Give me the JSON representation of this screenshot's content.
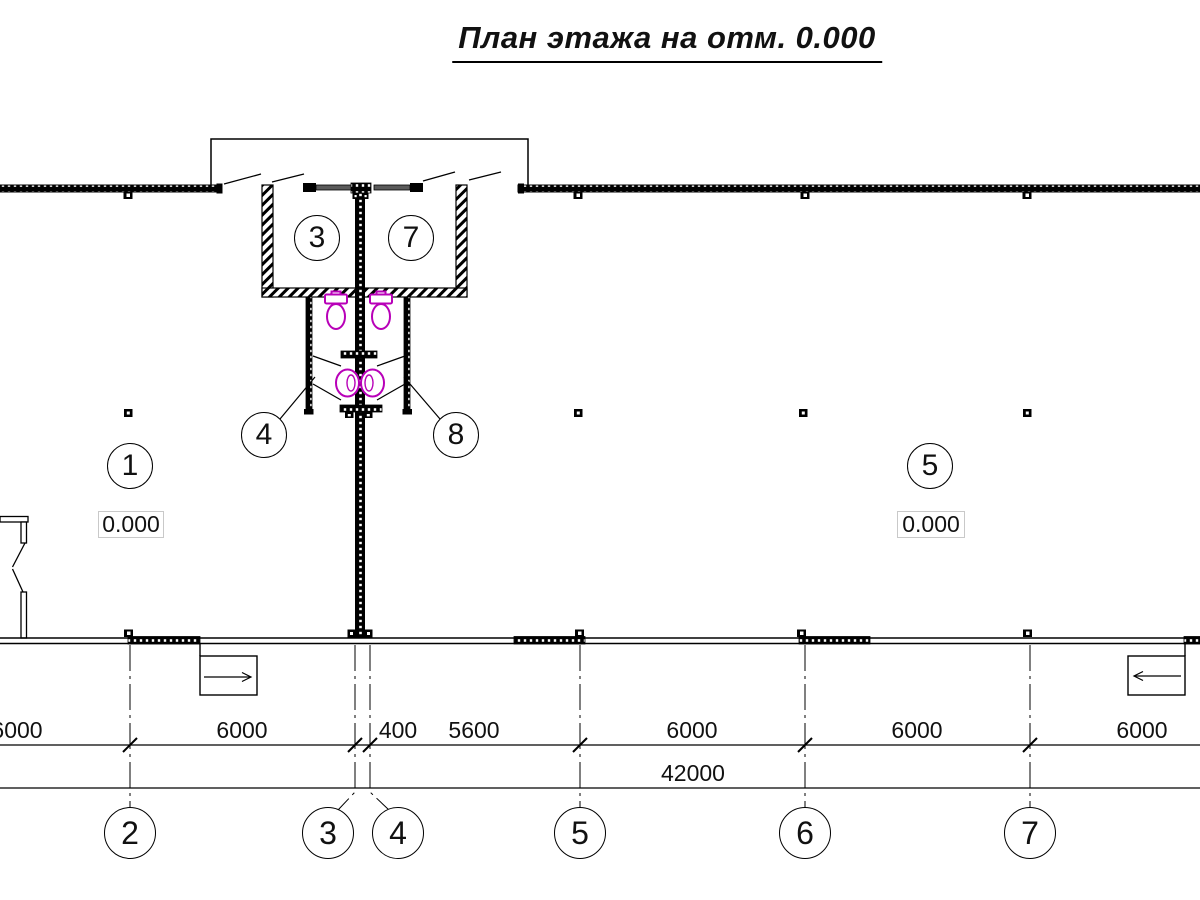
{
  "title": "План этажа на отм. 0.000",
  "colors": {
    "line": "#000000",
    "sanitary": "#b800b8",
    "window_glass": "#5a5a5a"
  },
  "rooms": [
    {
      "label": "1"
    },
    {
      "label": "3"
    },
    {
      "label": "7"
    },
    {
      "label": "4"
    },
    {
      "label": "8"
    },
    {
      "label": "5"
    }
  ],
  "elevations": [
    {
      "value": "0.000"
    },
    {
      "value": "0.000"
    }
  ],
  "axes": [
    {
      "label": "2"
    },
    {
      "label": "3"
    },
    {
      "label": "4"
    },
    {
      "label": "5"
    },
    {
      "label": "6"
    },
    {
      "label": "7"
    }
  ],
  "dimensions": {
    "row1": [
      {
        "value": "6000"
      },
      {
        "value": "6000"
      },
      {
        "value": "400"
      },
      {
        "value": "5600"
      },
      {
        "value": "6000"
      },
      {
        "value": "6000"
      },
      {
        "value": "6000"
      }
    ],
    "total": "42000"
  }
}
